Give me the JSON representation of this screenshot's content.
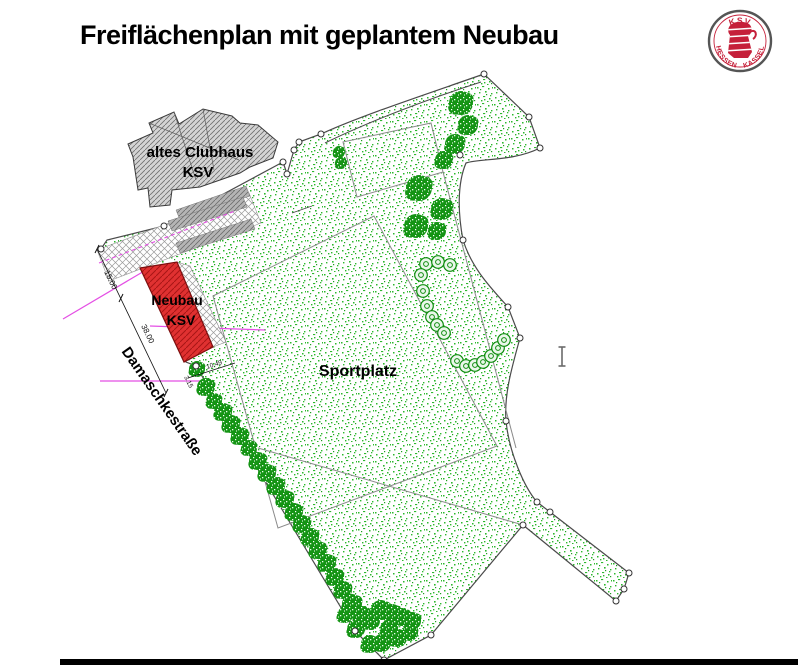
{
  "title": "Freiflächenplan mit geplantem Neubau",
  "logo": {
    "top_text": "KSV",
    "bottom_left_text": "HESSEN",
    "bottom_right_text": "KASSEL",
    "ring_color": "#555555",
    "emblem_color": "#c5203a"
  },
  "plan": {
    "labels": [
      {
        "id": "clubhaus-label-line1",
        "text": "altes Clubhaus",
        "x": 200,
        "y": 157,
        "size": 15,
        "rot": 0
      },
      {
        "id": "clubhaus-label-line2",
        "text": "KSV",
        "x": 198,
        "y": 177,
        "size": 15,
        "rot": 0
      },
      {
        "id": "neubau-label-line1",
        "text": "Neubau",
        "x": 177,
        "y": 305,
        "size": 14,
        "rot": 0
      },
      {
        "id": "neubau-label-line2",
        "text": "KSV",
        "x": 181,
        "y": 325,
        "size": 14,
        "rot": 0
      },
      {
        "id": "sportplatz-label",
        "text": "Sportplatz",
        "x": 358,
        "y": 376,
        "size": 16,
        "rot": 0
      },
      {
        "id": "street-label",
        "text": "Damaschkestraße",
        "x": 158,
        "y": 404,
        "size": 15,
        "rot": 55
      }
    ],
    "dimensions": {
      "labels": [
        {
          "id": "dim-15",
          "text": "15.00",
          "x": 104,
          "y": 272,
          "size": 8,
          "rot": 64
        },
        {
          "id": "dim-38",
          "text": "38.00",
          "x": 141,
          "y": 326,
          "size": 8,
          "rot": 64
        },
        {
          "id": "dim-315",
          "text": "3.15",
          "x": 184,
          "y": 377,
          "size": 6.5,
          "rot": 64
        },
        {
          "id": "dim-1049",
          "text": "10.49",
          "x": 207,
          "y": 369,
          "size": 6.5,
          "rot": -18
        }
      ],
      "line": [
        97,
        249,
        166,
        393
      ],
      "ticks": [
        [
          99,
          245,
          95,
          253
        ],
        [
          123,
          294,
          119,
          302
        ],
        [
          168,
          389,
          164,
          397
        ]
      ],
      "extra_segs": [
        [
          188,
          378,
          235,
          363
        ]
      ]
    },
    "colors": {
      "stipple_green": "#2eb82e",
      "tree_green": "#149414",
      "chain_tree_green": "#0d8c0d",
      "red_building": "#e03131",
      "red_hatch": "#a81515",
      "gray_building": "#d4d4d4",
      "boundary": "#4a4a4a",
      "inner_line": "#8a8a8a",
      "magenta": "#e44fe4"
    },
    "geometry": {
      "boundary": "M484,74 L529,117 L540,148 C512,162 480,158 466,163 C457,184 458,214 463,240 C472,269 492,289 508,307 L520,338 C511,370 504,396 506,421 C509,452 524,487 537,502 L550,512 L629,573 L624,589 L616,601 L523,525 L431,635 L384,660 L355,631 L196,366 L186,362 L141,268 L101,249 L107,240 L164,226 L283,162 L287,174 L294,150 L299,142 L321,134 C360,116 424,95 484,74 Z",
      "path_inner": "M325,143 C368,122 428,99 481,82",
      "parking_cover": [
        [
          97,
          250
        ],
        [
          249,
          193
        ],
        [
          261,
          223
        ],
        [
          109,
          281
        ]
      ],
      "parking_bands": [
        [
          [
            176,
            210
          ],
          [
            246,
            186
          ],
          [
            250,
            196
          ],
          [
            180,
            220
          ]
        ],
        [
          [
            168,
            221
          ],
          [
            243,
            197
          ],
          [
            247,
            207
          ],
          [
            172,
            231
          ]
        ],
        [
          [
            176,
            243
          ],
          [
            251,
            219
          ],
          [
            255,
            229
          ],
          [
            180,
            253
          ]
        ]
      ],
      "magenta_dash": [
        99,
        263,
        235,
        211
      ],
      "magenta_segs": [
        [
          63,
          319,
          146,
          270
        ],
        [
          150,
          326,
          265,
          330
        ],
        [
          100,
          381,
          208,
          381
        ]
      ],
      "big_quad": [
        [
          213,
          296
        ],
        [
          374,
          216
        ],
        [
          497,
          446
        ],
        [
          278,
          528
        ]
      ],
      "upper_quad": [
        [
          343,
          142
        ],
        [
          431,
          123
        ],
        [
          443,
          172
        ],
        [
          357,
          197
        ]
      ],
      "inner_segs": [
        [
          443,
          172,
          516,
          448
        ],
        [
          258,
          448,
          523,
          525
        ]
      ],
      "street_ticks": [
        [
          213,
          399,
          218,
          396
        ],
        [
          237,
          437,
          242,
          434
        ],
        [
          261,
          476,
          266,
          473
        ],
        [
          285,
          516,
          290,
          513
        ]
      ],
      "clubhouse": [
        [
          128,
          144
        ],
        [
          153,
          133
        ],
        [
          149,
          123
        ],
        [
          174,
          112
        ],
        [
          179,
          124
        ],
        [
          203,
          109
        ],
        [
          232,
          116
        ],
        [
          240,
          123
        ],
        [
          258,
          125
        ],
        [
          278,
          142
        ],
        [
          273,
          158
        ],
        [
          250,
          167
        ],
        [
          240,
          173
        ],
        [
          200,
          187
        ],
        [
          172,
          190
        ],
        [
          170,
          205
        ],
        [
          150,
          207
        ],
        [
          148,
          188
        ],
        [
          138,
          190
        ],
        [
          133,
          157
        ]
      ],
      "clubhouse_roof": [
        [
          149,
          123,
          239,
          160
        ],
        [
          174,
          112,
          196,
          180
        ],
        [
          203,
          109,
          214,
          170
        ]
      ],
      "red_building": [
        [
          140,
          268
        ],
        [
          177,
          262
        ],
        [
          213,
          347
        ],
        [
          184,
          362
        ]
      ],
      "red_strip": [
        [
          177,
          262
        ],
        [
          190,
          266
        ],
        [
          226,
          342
        ],
        [
          213,
          347
        ]
      ],
      "trees": [
        [
          461,
          103,
          12
        ],
        [
          468,
          125,
          10
        ],
        [
          455,
          144,
          10
        ],
        [
          444,
          160,
          9
        ],
        [
          339,
          152,
          6
        ],
        [
          341,
          163,
          6
        ],
        [
          419,
          188,
          13
        ],
        [
          442,
          209,
          11
        ],
        [
          416,
          226,
          12
        ],
        [
          437,
          231,
          9
        ],
        [
          197,
          369,
          8
        ],
        [
          206,
          387,
          9
        ],
        [
          214,
          401,
          8
        ],
        [
          223,
          412,
          9
        ],
        [
          231,
          424,
          9
        ],
        [
          240,
          436,
          9
        ],
        [
          249,
          448,
          8
        ],
        [
          258,
          461,
          9
        ],
        [
          267,
          473,
          9
        ],
        [
          276,
          486,
          9
        ],
        [
          285,
          499,
          9
        ],
        [
          294,
          512,
          9
        ],
        [
          302,
          524,
          9
        ],
        [
          310,
          537,
          9
        ],
        [
          318,
          550,
          9
        ],
        [
          327,
          563,
          9
        ],
        [
          335,
          577,
          9
        ],
        [
          343,
          590,
          9
        ],
        [
          352,
          604,
          10
        ],
        [
          362,
          615,
          9
        ],
        [
          356,
          629,
          9
        ],
        [
          371,
          621,
          9
        ],
        [
          381,
          610,
          10
        ],
        [
          392,
          613,
          9
        ],
        [
          402,
          617,
          9
        ],
        [
          412,
          621,
          9
        ],
        [
          389,
          629,
          9
        ],
        [
          370,
          644,
          9
        ],
        [
          382,
          643,
          9
        ],
        [
          398,
          638,
          9
        ],
        [
          410,
          633,
          8
        ],
        [
          345,
          615,
          8
        ]
      ],
      "chain_trees": [
        [
          426,
          264
        ],
        [
          438,
          262
        ],
        [
          450,
          265
        ],
        [
          421,
          275
        ],
        [
          423,
          291
        ],
        [
          427,
          306
        ],
        [
          432,
          317
        ],
        [
          437,
          325
        ],
        [
          444,
          333
        ],
        [
          457,
          361
        ],
        [
          466,
          366
        ],
        [
          475,
          365
        ],
        [
          483,
          362
        ],
        [
          491,
          356
        ],
        [
          498,
          348
        ],
        [
          504,
          340
        ]
      ],
      "vertices": [
        [
          484,
          74
        ],
        [
          529,
          117
        ],
        [
          540,
          148
        ],
        [
          460,
          155
        ],
        [
          463,
          240
        ],
        [
          508,
          307
        ],
        [
          520,
          338
        ],
        [
          506,
          421
        ],
        [
          537,
          502
        ],
        [
          550,
          512
        ],
        [
          629,
          573
        ],
        [
          624,
          589
        ],
        [
          616,
          601
        ],
        [
          523,
          525
        ],
        [
          431,
          635
        ],
        [
          384,
          660
        ],
        [
          355,
          631
        ],
        [
          196,
          366
        ],
        [
          283,
          162
        ],
        [
          287,
          174
        ],
        [
          294,
          150
        ],
        [
          299,
          142
        ],
        [
          321,
          134
        ],
        [
          164,
          226
        ],
        [
          101,
          249
        ]
      ],
      "path_arrow": [
        292,
        213,
        312,
        206
      ],
      "cursor": {
        "x": 562,
        "y": 347,
        "h": 19,
        "w": 7
      }
    }
  }
}
